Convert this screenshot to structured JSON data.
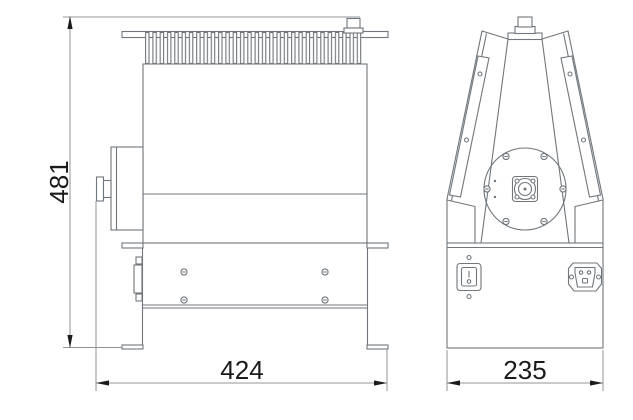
{
  "dimensions": {
    "height": "481",
    "width": "424",
    "depth": "235"
  },
  "colors": {
    "background": "#ffffff",
    "line_light": "#8f9499",
    "line_dark": "#70767b",
    "text": "#1b1b1b"
  }
}
